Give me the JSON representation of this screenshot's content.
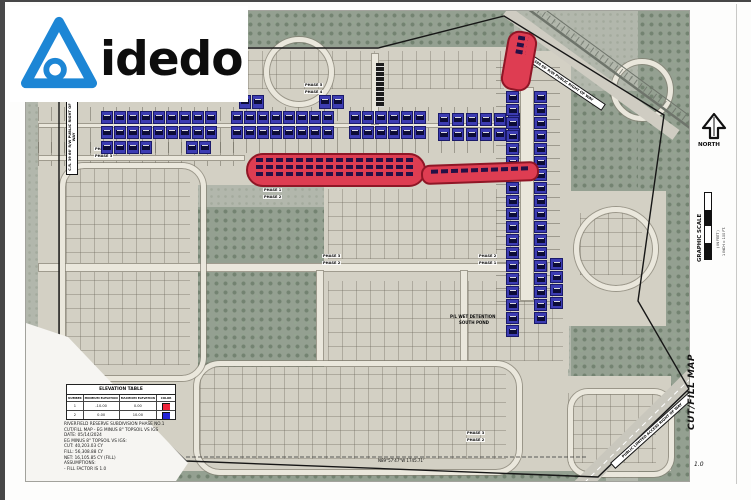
{
  "logo": {
    "word": "idedo"
  },
  "sheet": {
    "title_vertical": "CUT/FILL MAP",
    "page_number": "1.0",
    "north_label": "NORTH",
    "scale": {
      "title": "GRAPHIC SCALE",
      "in_feet": "( IN FEET )",
      "caption": "1 INCH = 100 FT."
    }
  },
  "elevation_table": {
    "title": "ELEVATION TABLE",
    "headers": [
      "NUMBER",
      "MINIMUM ELEVATION",
      "MAXIMUM ELEVATION",
      "COLOR"
    ],
    "rows": [
      {
        "number": "1",
        "min": "-10.00",
        "max": "0.00",
        "color_hex": "#ee2238"
      },
      {
        "number": "2",
        "min": "0.00",
        "max": "10.00",
        "color_hex": "#2424d6"
      }
    ]
  },
  "notes": {
    "lines": [
      "RIVERFIELD RESERVE SUBDIVISION PHASE NO.1",
      "CUT/FILL MAP - EG MINUS 8\" TOPSOIL VS IGS",
      "DATE: 05/14/2024",
      "EG MINUS 8\" TOPSOIL VS IGS:",
      "CUT: 40,203.03 CY",
      "FILL: 56,308.88 CY",
      "NET: 16,105.85 CY (FILL)",
      "ASSUMPTIONS:",
      "- FILL FACTOR IS 1.0"
    ]
  },
  "map": {
    "annotations": [
      {
        "t": "C.R. 39 66' R/W PUBLIC RIGHT OF WAY",
        "x": 40,
        "y": 164,
        "r": -90,
        "c": "roadbox",
        "w": 70
      },
      {
        "t": "C.R. 388 66' R/W PUBLIC RIGHT OF WAY",
        "x": 492,
        "y": 34,
        "r": 34,
        "c": "roadbox",
        "w": 100
      },
      {
        "t": "PUBLIC LIMITED ACCESS RIGHT OF WAY",
        "x": 584,
        "y": 452,
        "r": -42,
        "c": "roadbox",
        "w": 100
      },
      {
        "t": "P/L WET DETENTION WEST POND",
        "x": 224,
        "y": 150,
        "r": 0,
        "c": "pondlabel",
        "w": 64
      },
      {
        "t": "P/L WET DETENTION",
        "x": 424,
        "y": 304,
        "r": 0,
        "c": "plain",
        "w": 60
      },
      {
        "t": "SOUTH POND",
        "x": 433,
        "y": 310,
        "r": 0,
        "c": "plain",
        "w": 60
      },
      {
        "t": "PHASE 5",
        "x": 278,
        "y": 72,
        "r": 0,
        "c": "phase"
      },
      {
        "t": "PHASE 4",
        "x": 278,
        "y": 79,
        "r": 0,
        "c": "phase"
      },
      {
        "t": "PHASE 1",
        "x": 68,
        "y": 136,
        "r": 0,
        "c": "phase"
      },
      {
        "t": "PHASE 3",
        "x": 68,
        "y": 143,
        "r": 0,
        "c": "phase"
      },
      {
        "t": "PHASE 1",
        "x": 237,
        "y": 177,
        "r": 0,
        "c": "phase"
      },
      {
        "t": "PHASE 2",
        "x": 237,
        "y": 184,
        "r": 0,
        "c": "phase"
      },
      {
        "t": "PHASE 3",
        "x": 296,
        "y": 243,
        "r": 0,
        "c": "phase"
      },
      {
        "t": "PHASE 2",
        "x": 296,
        "y": 250,
        "r": 0,
        "c": "phase"
      },
      {
        "t": "PHASE 2",
        "x": 452,
        "y": 243,
        "r": 0,
        "c": "phase"
      },
      {
        "t": "PHASE 1",
        "x": 452,
        "y": 250,
        "r": 0,
        "c": "phase"
      },
      {
        "t": "PHASE 3",
        "x": 440,
        "y": 420,
        "r": 0,
        "c": "phase"
      },
      {
        "t": "PHASE 2",
        "x": 440,
        "y": 427,
        "r": 0,
        "c": "phase"
      },
      {
        "t": "N89°57'47\"W  1745.71'",
        "x": 352,
        "y": 448,
        "r": 0,
        "c": "dim"
      }
    ]
  },
  "cut_fill": {
    "blue_rows": [
      {
        "x": 75,
        "y": 100,
        "n": 9,
        "w": 12,
        "h": 13,
        "dx": 13
      },
      {
        "x": 205,
        "y": 100,
        "n": 8,
        "w": 12,
        "h": 13,
        "dx": 13
      },
      {
        "x": 323,
        "y": 100,
        "n": 6,
        "w": 12,
        "h": 13,
        "dx": 13
      },
      {
        "x": 412,
        "y": 102,
        "n": 6,
        "w": 12,
        "h": 13,
        "dx": 14
      },
      {
        "x": 75,
        "y": 115,
        "n": 9,
        "w": 12,
        "h": 13,
        "dx": 13
      },
      {
        "x": 205,
        "y": 115,
        "n": 8,
        "w": 12,
        "h": 13,
        "dx": 13
      },
      {
        "x": 323,
        "y": 115,
        "n": 6,
        "w": 12,
        "h": 13,
        "dx": 13
      },
      {
        "x": 412,
        "y": 117,
        "n": 6,
        "w": 12,
        "h": 13,
        "dx": 14
      },
      {
        "x": 75,
        "y": 130,
        "n": 4,
        "w": 12,
        "h": 13,
        "dx": 13
      },
      {
        "x": 160,
        "y": 130,
        "n": 2,
        "w": 12,
        "h": 13,
        "dx": 13
      },
      {
        "x": 213,
        "y": 84,
        "n": 2,
        "w": 12,
        "h": 14,
        "dx": 13
      },
      {
        "x": 293,
        "y": 84,
        "n": 2,
        "w": 12,
        "h": 14,
        "dx": 13
      }
    ],
    "blue_cols": [
      {
        "x": 480,
        "y": 80,
        "n": 16,
        "w": 13,
        "h": 12,
        "dy": 13
      },
      {
        "x": 508,
        "y": 80,
        "n": 16,
        "w": 13,
        "h": 12,
        "dy": 13
      },
      {
        "x": 480,
        "y": 288,
        "n": 3,
        "w": 13,
        "h": 12,
        "dy": 13
      },
      {
        "x": 508,
        "y": 288,
        "n": 2,
        "w": 13,
        "h": 12,
        "dy": 13
      },
      {
        "x": 524,
        "y": 247,
        "n": 4,
        "w": 13,
        "h": 12,
        "dy": 13
      }
    ],
    "red_areas": [
      {
        "x": 220,
        "y": 142,
        "w": 180,
        "h": 34,
        "rad": 17,
        "rot": 0,
        "chips": 3
      },
      {
        "x": 395,
        "y": 152,
        "w": 118,
        "h": 20,
        "rad": 9,
        "rot": -2,
        "chips": 1
      },
      {
        "x": 478,
        "y": 20,
        "w": 30,
        "h": 60,
        "rad": 12,
        "rot": 10,
        "chips": 3
      }
    ]
  }
}
